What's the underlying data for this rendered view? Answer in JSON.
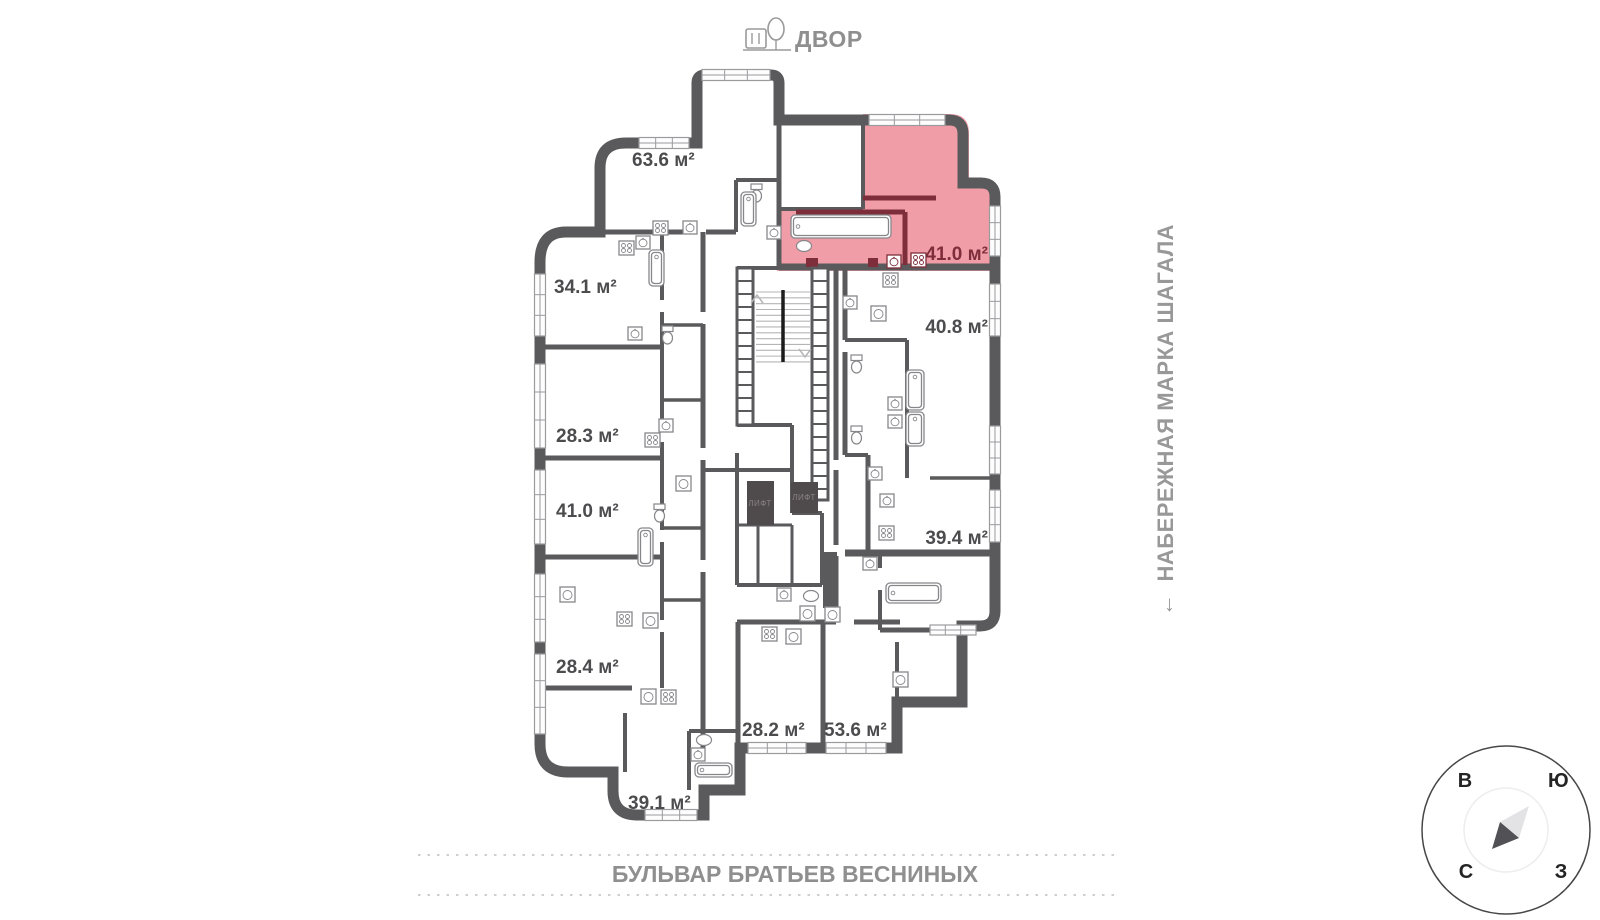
{
  "plan": {
    "courtyard_label": "ДВОР",
    "street_right": "НАБЕРЕЖНАЯ МАРКА ШАГАЛА",
    "street_bottom": "БУЛЬВАР БРАТЬЕВ ВЕСНИНЫХ",
    "apartments": [
      {
        "area": "63.6 м²",
        "highlighted": false
      },
      {
        "area": "34.1 м²",
        "highlighted": false
      },
      {
        "area": "28.3 м²",
        "highlighted": false
      },
      {
        "area": "41.0 м²",
        "highlighted": false
      },
      {
        "area": "28.4 м²",
        "highlighted": false
      },
      {
        "area": "39.1 м²",
        "highlighted": false
      },
      {
        "area": "28.2 м²",
        "highlighted": false
      },
      {
        "area": "53.6 м²",
        "highlighted": false
      },
      {
        "area": "41.0 м²",
        "highlighted": true
      },
      {
        "area": "40.8 м²",
        "highlighted": false
      },
      {
        "area": "39.4 м²",
        "highlighted": false
      }
    ],
    "elevator_label": "ЛИФТ",
    "compass": {
      "top_left": "В",
      "top_right": "Ю",
      "bottom_left": "С",
      "bottom_right": "З"
    },
    "icons": {
      "direction_arrow": "←",
      "courtyard_icon": "bench-and-tree"
    },
    "colors": {
      "wall": "#5a5a5c",
      "highlight_fill": "#f09da8",
      "highlight_wall": "#7e2e3a",
      "area_label": "#4c4c4e",
      "street_label": "#8f8f8f"
    }
  }
}
